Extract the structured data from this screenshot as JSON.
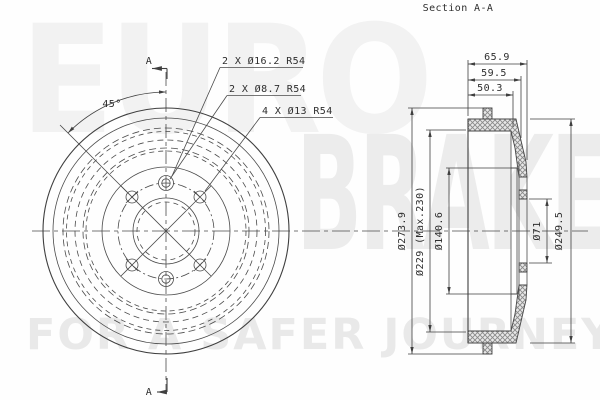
{
  "page": {
    "section_title": "Section A-A"
  },
  "watermark": {
    "line1": "EURO",
    "line2": "BRAKE",
    "tagline": "FOR A SAFER JOURNEY"
  },
  "front_view": {
    "section_marker_top": "A",
    "section_marker_bottom": "A",
    "angle_label": "45°",
    "callouts": {
      "counterbore": "2 X Ø16.2 R54",
      "small_hole": "2 X Ø8.7 R54",
      "bolt_holes": "4 X Ø13 R54"
    }
  },
  "section_view": {
    "depths": {
      "total": "65.9",
      "mid": "59.5",
      "inner": "50.3"
    },
    "diameters": {
      "flange": "Ø273.9",
      "drum_inner": "Ø229 (Max.230)",
      "hub_recess": "Ø140.6",
      "center_bore": "Ø71",
      "drum_outer": "Ø249.5"
    }
  },
  "colors": {
    "line": "#3f3f3f",
    "watermark": "#ececec",
    "background": "#fefefe"
  }
}
